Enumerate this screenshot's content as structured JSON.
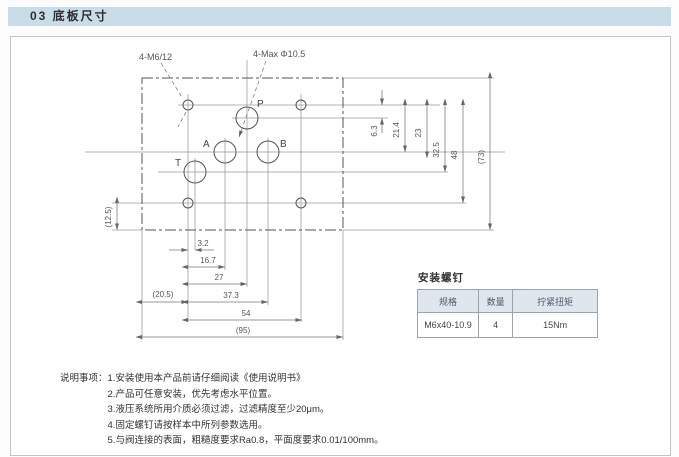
{
  "page": {
    "section_title": "03 底板尺寸"
  },
  "colors": {
    "header_bar_bg": "#cbdce9",
    "table_header_bg": "#dfe7ee",
    "drawing_line": "#777777"
  },
  "drawing": {
    "callouts": {
      "bolts": "4-M6/12",
      "ports": "4-Max Φ10.5"
    },
    "ports": {
      "p": "P",
      "a": "A",
      "b": "B",
      "t": "T"
    },
    "dims_horizontal": [
      "3.2",
      "16.7",
      "27",
      "(20.5)",
      "37.3",
      "54",
      "(95)"
    ],
    "dims_vertical": [
      "6.3",
      "21.4",
      "23",
      "32.5",
      "48",
      "(73)"
    ],
    "dim_left": "(12.5)"
  },
  "screw_table": {
    "title": "安装螺钉",
    "headers": [
      "规格",
      "数量",
      "拧紧扭矩"
    ],
    "rows": [
      [
        "M6x40-10.9",
        "4",
        "15Nm"
      ]
    ]
  },
  "notes": {
    "label": "说明事项：",
    "items": [
      "1.安装使用本产品前请仔细阅读《使用说明书》",
      "2.产品可任意安装，优先考虑水平位置。",
      "3.液压系统所用介质必须过滤，过滤精度至少20μm。",
      "4.固定螺钉请按样本中所列参数选用。",
      "5.与阀连接的表面，粗糙度要求Ra0.8，平面度要求0.01/100mm。"
    ]
  }
}
